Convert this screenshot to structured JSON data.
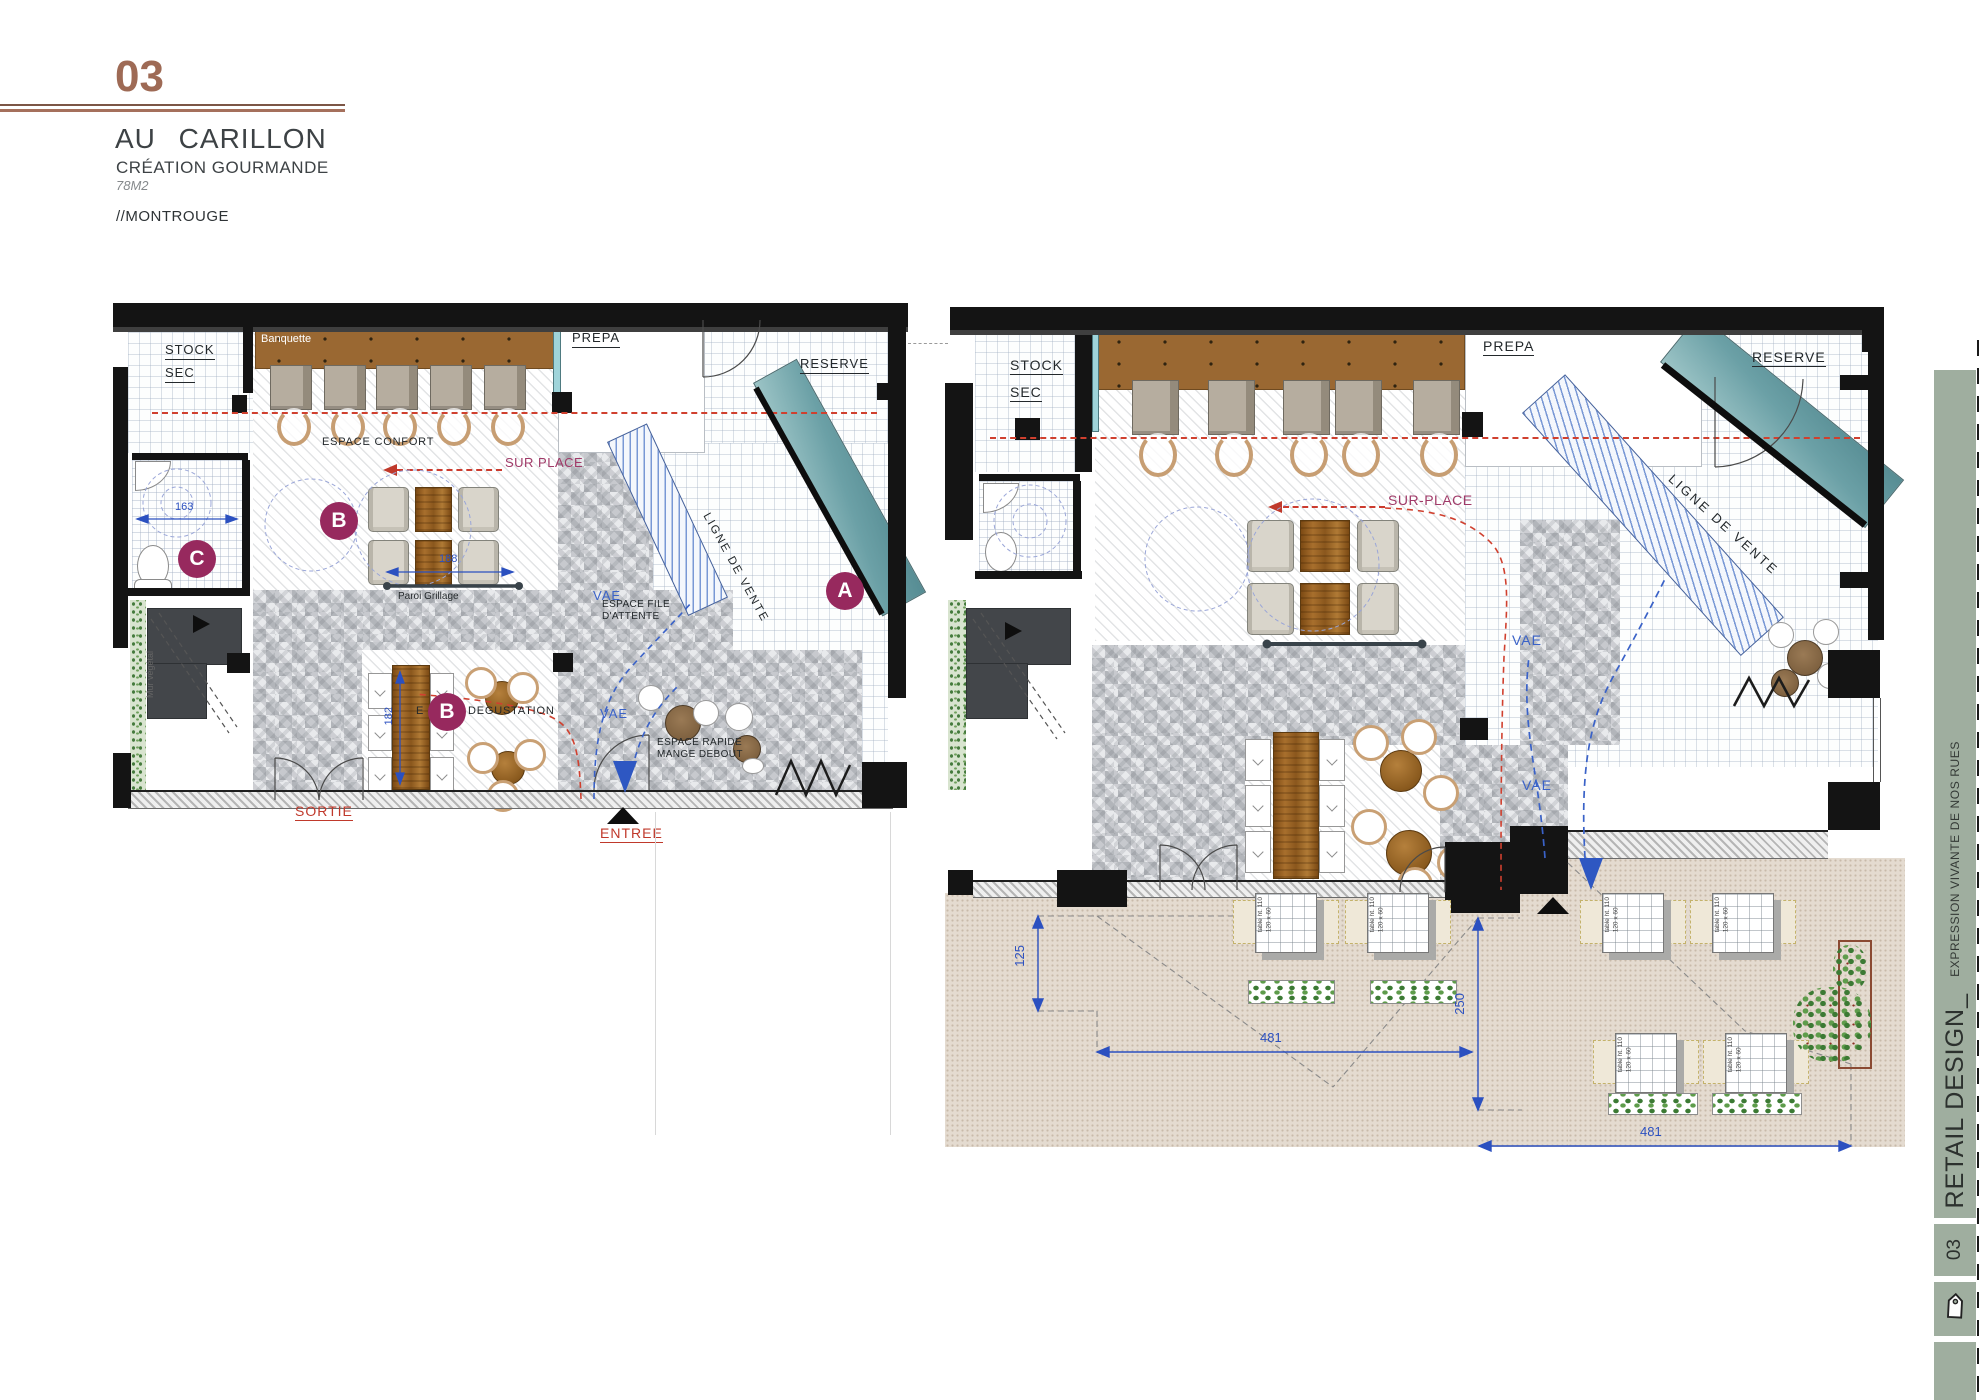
{
  "header": {
    "number": "03",
    "title": "AU CARILLON",
    "subtitle": "CRÉATION GOURMANDE",
    "area": "78M2",
    "location": "//MONTROUGE"
  },
  "sidebar": {
    "title": "RETAIL DESIGN_",
    "tagline": "EXPRESSION VIVANTE DE NOS RUES",
    "number": "03",
    "icon": "tag-icon",
    "color": "#9fae9f"
  },
  "plan_small": {
    "title_labels": {
      "stock_line1": "STOCK",
      "stock_line2": "SEC",
      "prepa": "PREPA",
      "reserve": "RESERVE"
    },
    "zones": {
      "banquette": "Banquette",
      "espace_confort": "ESPACE CONFORT",
      "sur_place": "SUR PLACE",
      "paroi_grillage": "Paroi Grillage",
      "degustation_prefix": "E",
      "degustation_suffix": "DEGUSTATION",
      "espace_file_line1": "ESPACE FILE",
      "espace_file_line2": "D'ATTENTE",
      "espace_rapide_line1": "ESPACE RAPIDE",
      "espace_rapide_line2": "MANGE DEBOUT",
      "ligne_de_vente": "LIGNE DE VENTE",
      "mur_vegetal": "Mur végétal",
      "vae": "VAE"
    },
    "circulation": {
      "sortie": "SORTIE",
      "entree": "ENTREE"
    },
    "markers": {
      "a": "A",
      "b": "B",
      "c": "C"
    },
    "dimensions": {
      "d163": "163",
      "d188": "188",
      "d182": "182"
    }
  },
  "plan_large": {
    "title_labels": {
      "stock_line1": "STOCK",
      "stock_line2": "SEC",
      "prepa": "PREPA",
      "reserve": "RESERVE"
    },
    "zones": {
      "sur_place": "SUR-PLACE",
      "ligne_de_vente": "LIGNE DE VENTE",
      "vae": "VAE"
    },
    "dimensions": {
      "d125": "125",
      "d481_top": "481",
      "d250": "250",
      "d481_bottom": "481"
    },
    "terrace_table_label_line1": "table ht. 110",
    "terrace_table_label_line2": "120 x 60"
  },
  "palette": {
    "accent_brown": "#9e6a55",
    "marker_magenta": "#97295e",
    "dimension_blue": "#2b50c0",
    "route_red": "#d0402f",
    "route_blue": "#3a62c8",
    "sur_place_magenta": "#a03a68",
    "sidebar_green": "#9fae9f",
    "banquette_brown": "#9a6832",
    "counter_teal": "#6ba0a6",
    "wood_brown": "#a5702e",
    "terrace_beige": "#e4dbd0",
    "tile_gray": "#e6e7e9"
  }
}
